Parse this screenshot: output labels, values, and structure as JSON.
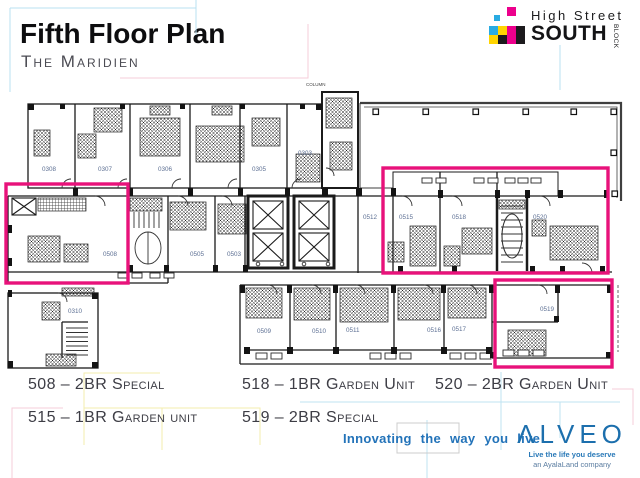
{
  "header": {
    "title": "Fifth Floor Plan",
    "subtitle": "The Maridien"
  },
  "logo": {
    "line1": "High Street",
    "line2": "SOUTH",
    "vertical": "BLOCK",
    "colors": {
      "cyan": "#29abe2",
      "magenta": "#ec008c",
      "yellow": "#ffd400",
      "black": "#1c1a1d"
    },
    "cells": [
      {
        "x": 18,
        "y": 0,
        "s": 9,
        "c": "magenta"
      },
      {
        "x": 5,
        "y": 8,
        "s": 6,
        "c": "cyan"
      },
      {
        "x": 0,
        "y": 19,
        "s": 9,
        "c": "cyan"
      },
      {
        "x": 9,
        "y": 19,
        "s": 9,
        "c": "yellow"
      },
      {
        "x": 18,
        "y": 19,
        "s": 9,
        "c": "magenta"
      },
      {
        "x": 27,
        "y": 19,
        "s": 9,
        "c": "black"
      },
      {
        "x": 0,
        "y": 28,
        "s": 9,
        "c": "yellow"
      },
      {
        "x": 9,
        "y": 28,
        "s": 9,
        "c": "black"
      },
      {
        "x": 18,
        "y": 28,
        "s": 9,
        "c": "magenta"
      },
      {
        "x": 27,
        "y": 28,
        "s": 9,
        "c": "black"
      }
    ]
  },
  "plan": {
    "note": "COLUMN",
    "highlight_color": "#e8127a",
    "units": [
      {
        "n": "0308",
        "x": 42,
        "y": 171
      },
      {
        "n": "0307",
        "x": 98,
        "y": 171
      },
      {
        "n": "0306",
        "x": 158,
        "y": 171
      },
      {
        "n": "0305",
        "x": 252,
        "y": 171
      },
      {
        "n": "0303",
        "x": 298,
        "y": 155
      },
      {
        "n": "0508",
        "x": 103,
        "y": 256
      },
      {
        "n": "0505",
        "x": 190,
        "y": 256
      },
      {
        "n": "0503",
        "x": 227,
        "y": 256
      },
      {
        "n": "0512",
        "x": 363,
        "y": 219
      },
      {
        "n": "0515",
        "x": 399,
        "y": 219
      },
      {
        "n": "0518",
        "x": 452,
        "y": 219
      },
      {
        "n": "0520",
        "x": 533,
        "y": 219
      },
      {
        "n": "0310",
        "x": 68,
        "y": 313
      },
      {
        "n": "0509",
        "x": 257,
        "y": 333
      },
      {
        "n": "0510",
        "x": 312,
        "y": 333
      },
      {
        "n": "0511",
        "x": 346,
        "y": 332
      },
      {
        "n": "0516",
        "x": 427,
        "y": 332
      },
      {
        "n": "0517",
        "x": 452,
        "y": 331
      },
      {
        "n": "0519",
        "x": 540,
        "y": 311
      }
    ],
    "highlights": [
      {
        "x": 6,
        "y": 184,
        "w": 122,
        "h": 99
      },
      {
        "x": 383,
        "y": 168,
        "w": 225,
        "h": 105
      },
      {
        "x": 495,
        "y": 280,
        "w": 117,
        "h": 87
      }
    ]
  },
  "legend": {
    "items": [
      {
        "label": "508 – 2BR Special",
        "col": 1,
        "row": 1
      },
      {
        "label": "518 – 1BR Garden Unit",
        "col": 2,
        "row": 1
      },
      {
        "label": "520 – 2BR Garden Unit",
        "col": 3,
        "row": 1
      },
      {
        "label": "515 – 1BR Garden unit",
        "col": 1,
        "row": 2
      },
      {
        "label": "519 – 2BR Special",
        "col": 2,
        "row": 2
      }
    ]
  },
  "footer": {
    "tagline": "Innovating the way you live",
    "brand": "ALVEO",
    "brand_sub1": "Live the life you deserve",
    "brand_sub2": "an AyalaLand company"
  }
}
